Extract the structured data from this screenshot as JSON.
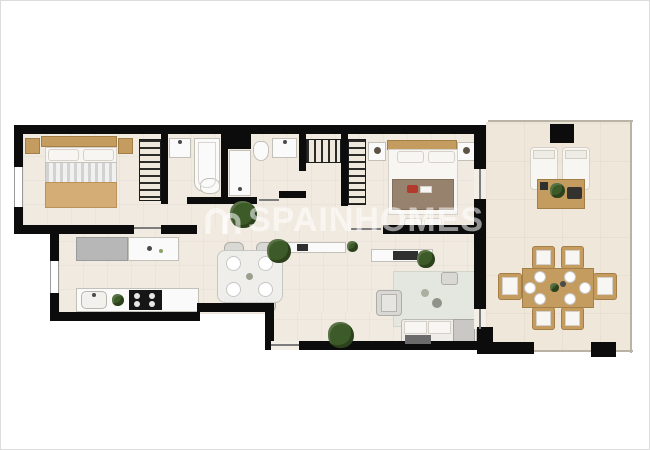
{
  "image": {
    "kind": "apartment-floor-plan-render",
    "width_px": 650,
    "height_px": 450
  },
  "watermark": {
    "text": "SPAINHOMES",
    "logo": "double-arch-logo",
    "color": "#ffffff",
    "opacity": 0.55
  },
  "palette": {
    "wall": "#0c0c0c",
    "indoor_floor": "#f1eae1",
    "terrace_floor": "#efe7da",
    "wood": "#c59c60",
    "counter_gray": "#b7b7b7",
    "rug": "#e4e7df",
    "plant_green": "#3d5b28",
    "blanket_tan": "#d4ac76",
    "blanket_brown": "#97826d",
    "accent_red": "#b23a2c"
  },
  "rooms": [
    {
      "name": "bedroom-1",
      "furniture": [
        "double-bed",
        "nightstand-left",
        "nightstand-right",
        "wardrobe",
        "window"
      ]
    },
    {
      "name": "bathroom-1",
      "furniture": [
        "washbasin",
        "bathtub",
        "toilet"
      ]
    },
    {
      "name": "bathroom-2",
      "furniture": [
        "shower",
        "toilet",
        "washbasin"
      ]
    },
    {
      "name": "hallway",
      "furniture": [
        "plant",
        "console",
        "plant"
      ]
    },
    {
      "name": "kitchen",
      "furniture": [
        "fridge-counter",
        "worktop",
        "sink",
        "cooktop",
        "plant",
        "window"
      ]
    },
    {
      "name": "dining-area",
      "furniture": [
        "glass-table",
        "chair",
        "chair",
        "chair",
        "chair",
        "plates"
      ]
    },
    {
      "name": "living-room",
      "furniture": [
        "sofa",
        "chaise",
        "armchair",
        "rug",
        "tv-sideboard",
        "pouf",
        "plant"
      ]
    },
    {
      "name": "bedroom-2",
      "furniture": [
        "double-bed",
        "nightstand-left",
        "nightstand-right",
        "wardrobe-a",
        "wardrobe-b",
        "bench",
        "red-cushion"
      ]
    },
    {
      "name": "terrace",
      "furniture": [
        "sun-lounger",
        "sun-lounger",
        "coffee-table",
        "plant",
        "dining-table",
        "chair",
        "chair",
        "chair",
        "chair",
        "chair",
        "chair"
      ]
    }
  ]
}
